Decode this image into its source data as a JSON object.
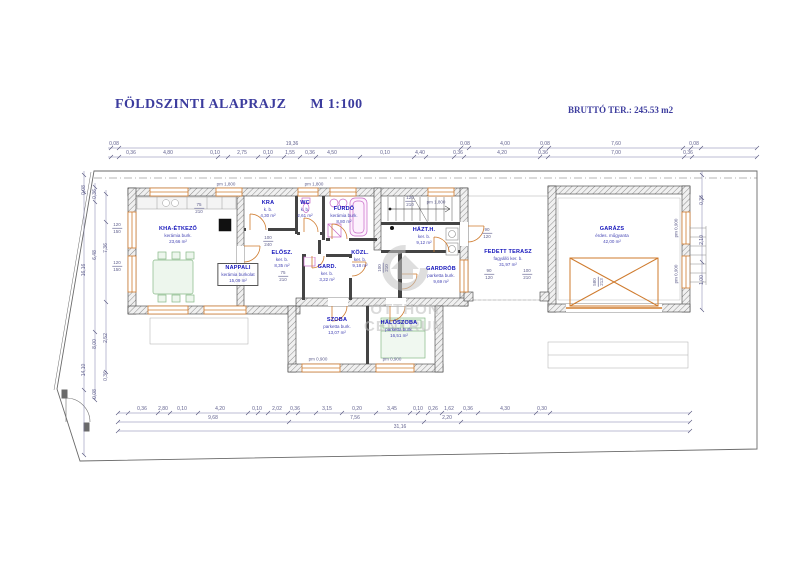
{
  "header": {
    "title": "FÖLDSZINTI ALAPRAJZ",
    "scale": "M 1:100",
    "gross_area": "BRUTTÓ TER.: 245.53 m2"
  },
  "watermark": {
    "line1": "OTTHON",
    "line2": "CENTRUM"
  },
  "rooms": [
    {
      "name": "KHA-ÉTKEZŐ",
      "finish": "kerámia burk.",
      "area": "23,66 m²"
    },
    {
      "name": "NAPPALI",
      "finish": "kerámia burkolat",
      "area": "15,09 m²"
    },
    {
      "name": "KRA",
      "finish": "k. b.",
      "area": "4,30 m²"
    },
    {
      "name": "WC",
      "finish": "k. b.",
      "area": "2,61 m²"
    },
    {
      "name": "FÜRDŐ",
      "finish": "kerámia burk.",
      "area": "8,80 m²"
    },
    {
      "name": "HÁZT.H.",
      "finish": "ker. b.",
      "area": "9,12 m²"
    },
    {
      "name": "ELŐSZ.",
      "finish": "ker. b.",
      "area": "8,35 m²"
    },
    {
      "name": "KÖZL.",
      "finish": "ker. b.",
      "area": "9,18 m²"
    },
    {
      "name": "GARD.",
      "finish": "ker. b.",
      "area": "3,22 m²"
    },
    {
      "name": "GARDRÓB",
      "finish": "parketta burk.",
      "area": "9,69 m²"
    },
    {
      "name": "SZOBA",
      "finish": "parketta burk.",
      "area": "13,07 m²"
    },
    {
      "name": "HÁLÓSZOBA",
      "finish": "parketta burk.",
      "area": "16,51 m²"
    },
    {
      "name": "FEDETT TERASZ",
      "finish": "fagyálló ker. b.",
      "area": "31,97 m²"
    },
    {
      "name": "GARÁZS",
      "finish": "érdes. műgyanta",
      "area": "42,00 m²"
    }
  ],
  "dims": {
    "top_row1": [
      "0,08",
      "19,36",
      "0,08",
      "4,00",
      "0,08",
      "7,60",
      "0,08"
    ],
    "top_row2": [
      "0,36",
      "4,80",
      "0,10",
      "2,75",
      "0,10",
      "1,55",
      "0,36",
      "4,50",
      "0,10",
      "4,40",
      "0,36",
      "4,20",
      "0,36",
      "7,00",
      "0,36"
    ],
    "bottom_row1": [
      "0,36",
      "2,80",
      "0,10",
      "4,20",
      "0,10",
      "2,02",
      "0,36",
      "3,15",
      "0,20",
      "3,45",
      "0,10",
      "0,26",
      "1,62",
      "0,36",
      "4,30",
      "0,30"
    ],
    "bottom_row2": [
      "9,68",
      "7,56",
      "2,20"
    ],
    "bottom_total": "31,16",
    "left": [
      "0,08",
      "0,36",
      "7,36",
      "6,48",
      "16,16",
      "2,52",
      "8,00",
      "0,36",
      "0,08",
      "14,10"
    ],
    "right": [
      "0,36",
      "2,10",
      "1,00"
    ]
  },
  "opening_heights": {
    "top": "pm 1,800",
    "bottom": "pm 0,900"
  },
  "openings": [
    {
      "w": "75",
      "h": "210"
    },
    {
      "w": "100",
      "h": "240"
    },
    {
      "w": "75",
      "h": "210"
    },
    {
      "w": "100",
      "h": "210"
    },
    {
      "w": "120",
      "h": "210"
    },
    {
      "w": "90",
      "h": "120"
    },
    {
      "w": "90",
      "h": "120"
    },
    {
      "w": "100",
      "h": "210"
    },
    {
      "w": "120",
      "h": "150"
    },
    {
      "w": "120",
      "h": "150"
    },
    {
      "w": "580",
      "h": "213"
    }
  ]
}
